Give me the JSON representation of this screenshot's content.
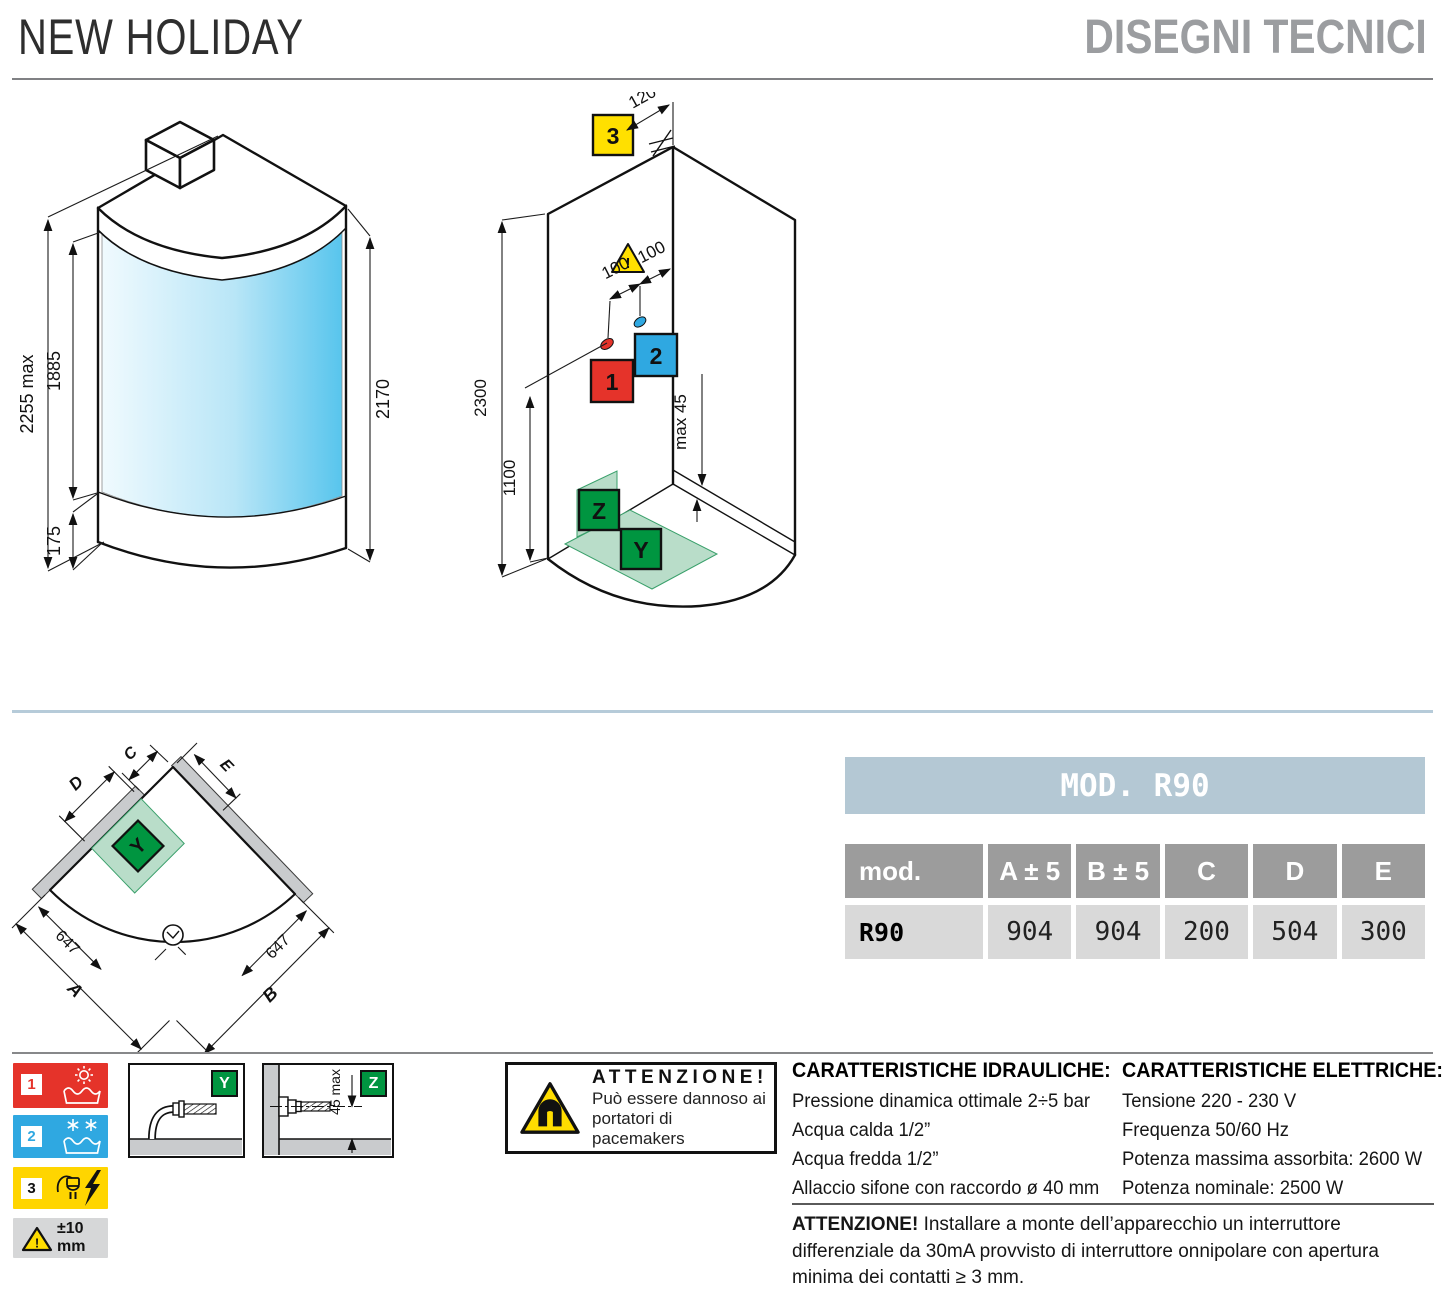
{
  "header": {
    "title": "NEW HOLIDAY",
    "subtitle": "DISEGNI TECNICI"
  },
  "colors": {
    "accent_red": "#e5332a",
    "accent_blue": "#2fa8e1",
    "accent_yellow": "#ffd900",
    "accent_green": "#009540",
    "green_zone": "#b9ddc9",
    "glass_blue": "#58c5ed",
    "table_title_bg": "#b4c8d4",
    "table_header_bg": "#9c9c9c",
    "table_cell_bg": "#d9d9d9",
    "wall_gray": "#c9cbcd"
  },
  "iso": {
    "dims": {
      "total": "2255 max",
      "glass": "1885",
      "tray": "175",
      "door": "2170"
    }
  },
  "install": {
    "dims": {
      "electric": "120",
      "height": "2300",
      "mixer": "1100",
      "spacing1": "100",
      "spacing2": "100",
      "step": "max 45"
    },
    "badges": {
      "electric": "3",
      "hot": "1",
      "cold": "2",
      "wall": "Z",
      "floor": "Y"
    },
    "warning_mark": "!"
  },
  "plan": {
    "labels": {
      "a": "A",
      "b": "B",
      "c": "C",
      "d": "D",
      "e": "E"
    },
    "dims": {
      "left": "647",
      "right": "647"
    },
    "zone": "Y"
  },
  "table": {
    "title": "MOD. R90",
    "headers": [
      "mod.",
      "A ± 5",
      "B ± 5",
      "C",
      "D",
      "E"
    ],
    "row": {
      "model": "R90",
      "values": [
        "904",
        "904",
        "200",
        "504",
        "300"
      ]
    }
  },
  "legend": {
    "items": [
      {
        "num": "1",
        "type": "hot-water"
      },
      {
        "num": "2",
        "type": "cold-water"
      },
      {
        "num": "3",
        "type": "electric"
      }
    ],
    "tolerance": "±10 mm",
    "tolerance_mark": "!"
  },
  "details": {
    "y": {
      "label": "Y"
    },
    "z": {
      "label": "Z",
      "dim": "45 max"
    }
  },
  "magnet": {
    "title": "ATTENZIONE!",
    "line1": "Può essere dannoso ai",
    "line2": "portatori di pacemakers"
  },
  "hydraulics": {
    "title": "CARATTERISTICHE IDRAULICHE:",
    "lines": [
      "Pressione dinamica ottimale 2÷5 bar",
      "Acqua calda 1/2”",
      "Acqua fredda 1/2”",
      "Allaccio sifone con raccordo ø 40 mm"
    ]
  },
  "electrics": {
    "title": "CARATTERISTICHE ELETTRICHE:",
    "lines": [
      "Tensione 220 - 230 V",
      "Frequenza 50/60 Hz",
      "Potenza massima assorbita: 2600 W",
      "Potenza nominale: 2500 W"
    ]
  },
  "note": {
    "title": "ATTENZIONE!",
    "text": " Installare a monte dell’apparecchio un interruttore differenziale da 30mA provvisto di interruttore onnipolare con apertura minima dei contatti ≥ 3 mm."
  }
}
